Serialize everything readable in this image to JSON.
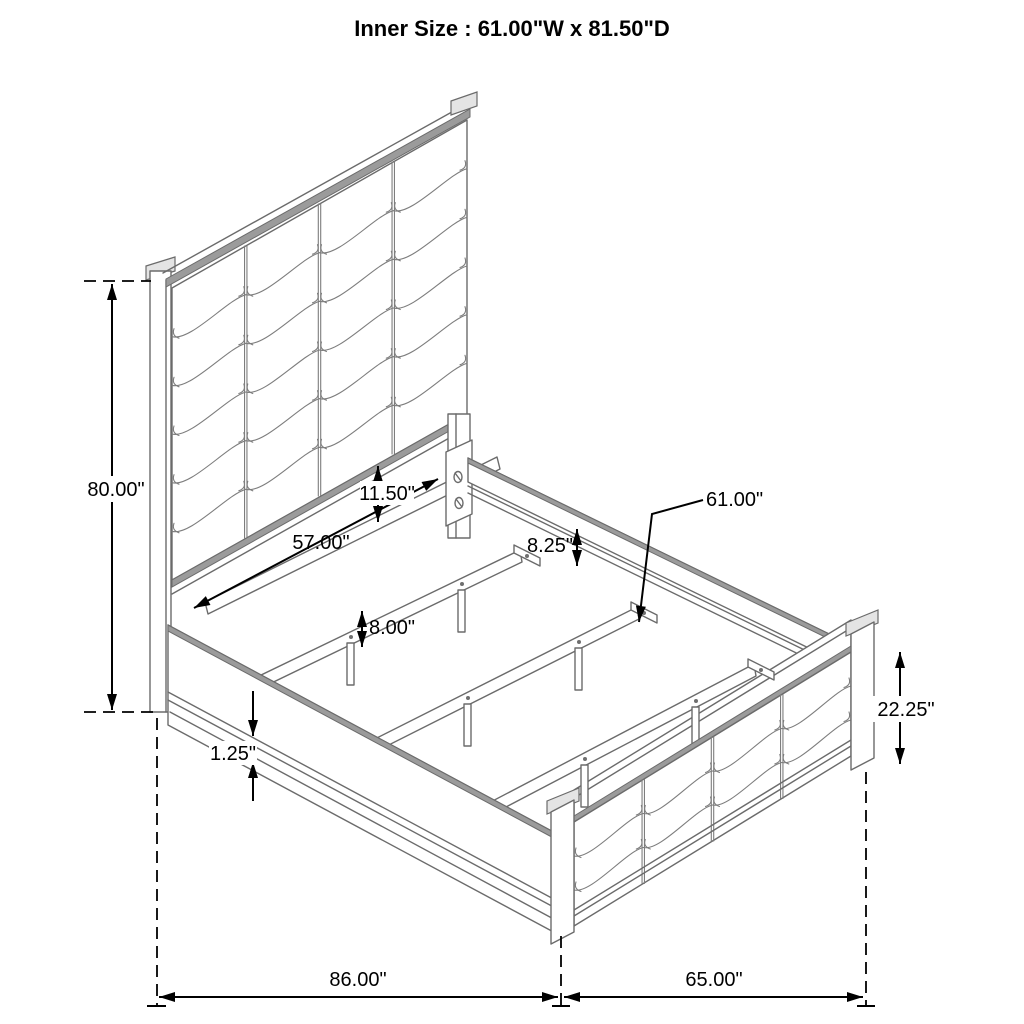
{
  "title": "Inner Size : 61.00\"W x 81.50\"D",
  "dimensions": {
    "headboard_height": "80.00\"",
    "cleat_length": "57.00\"",
    "headboard_to_cleat": "11.50\"",
    "rail_to_slat_drop": "8.25\"",
    "slat_length": "61.00\"",
    "support_leg_height": "8.00\"",
    "rail_trim_thickness": "1.25\"",
    "footboard_height": "22.25\"",
    "overall_depth": "86.00\"",
    "overall_width": "65.00\""
  }
}
